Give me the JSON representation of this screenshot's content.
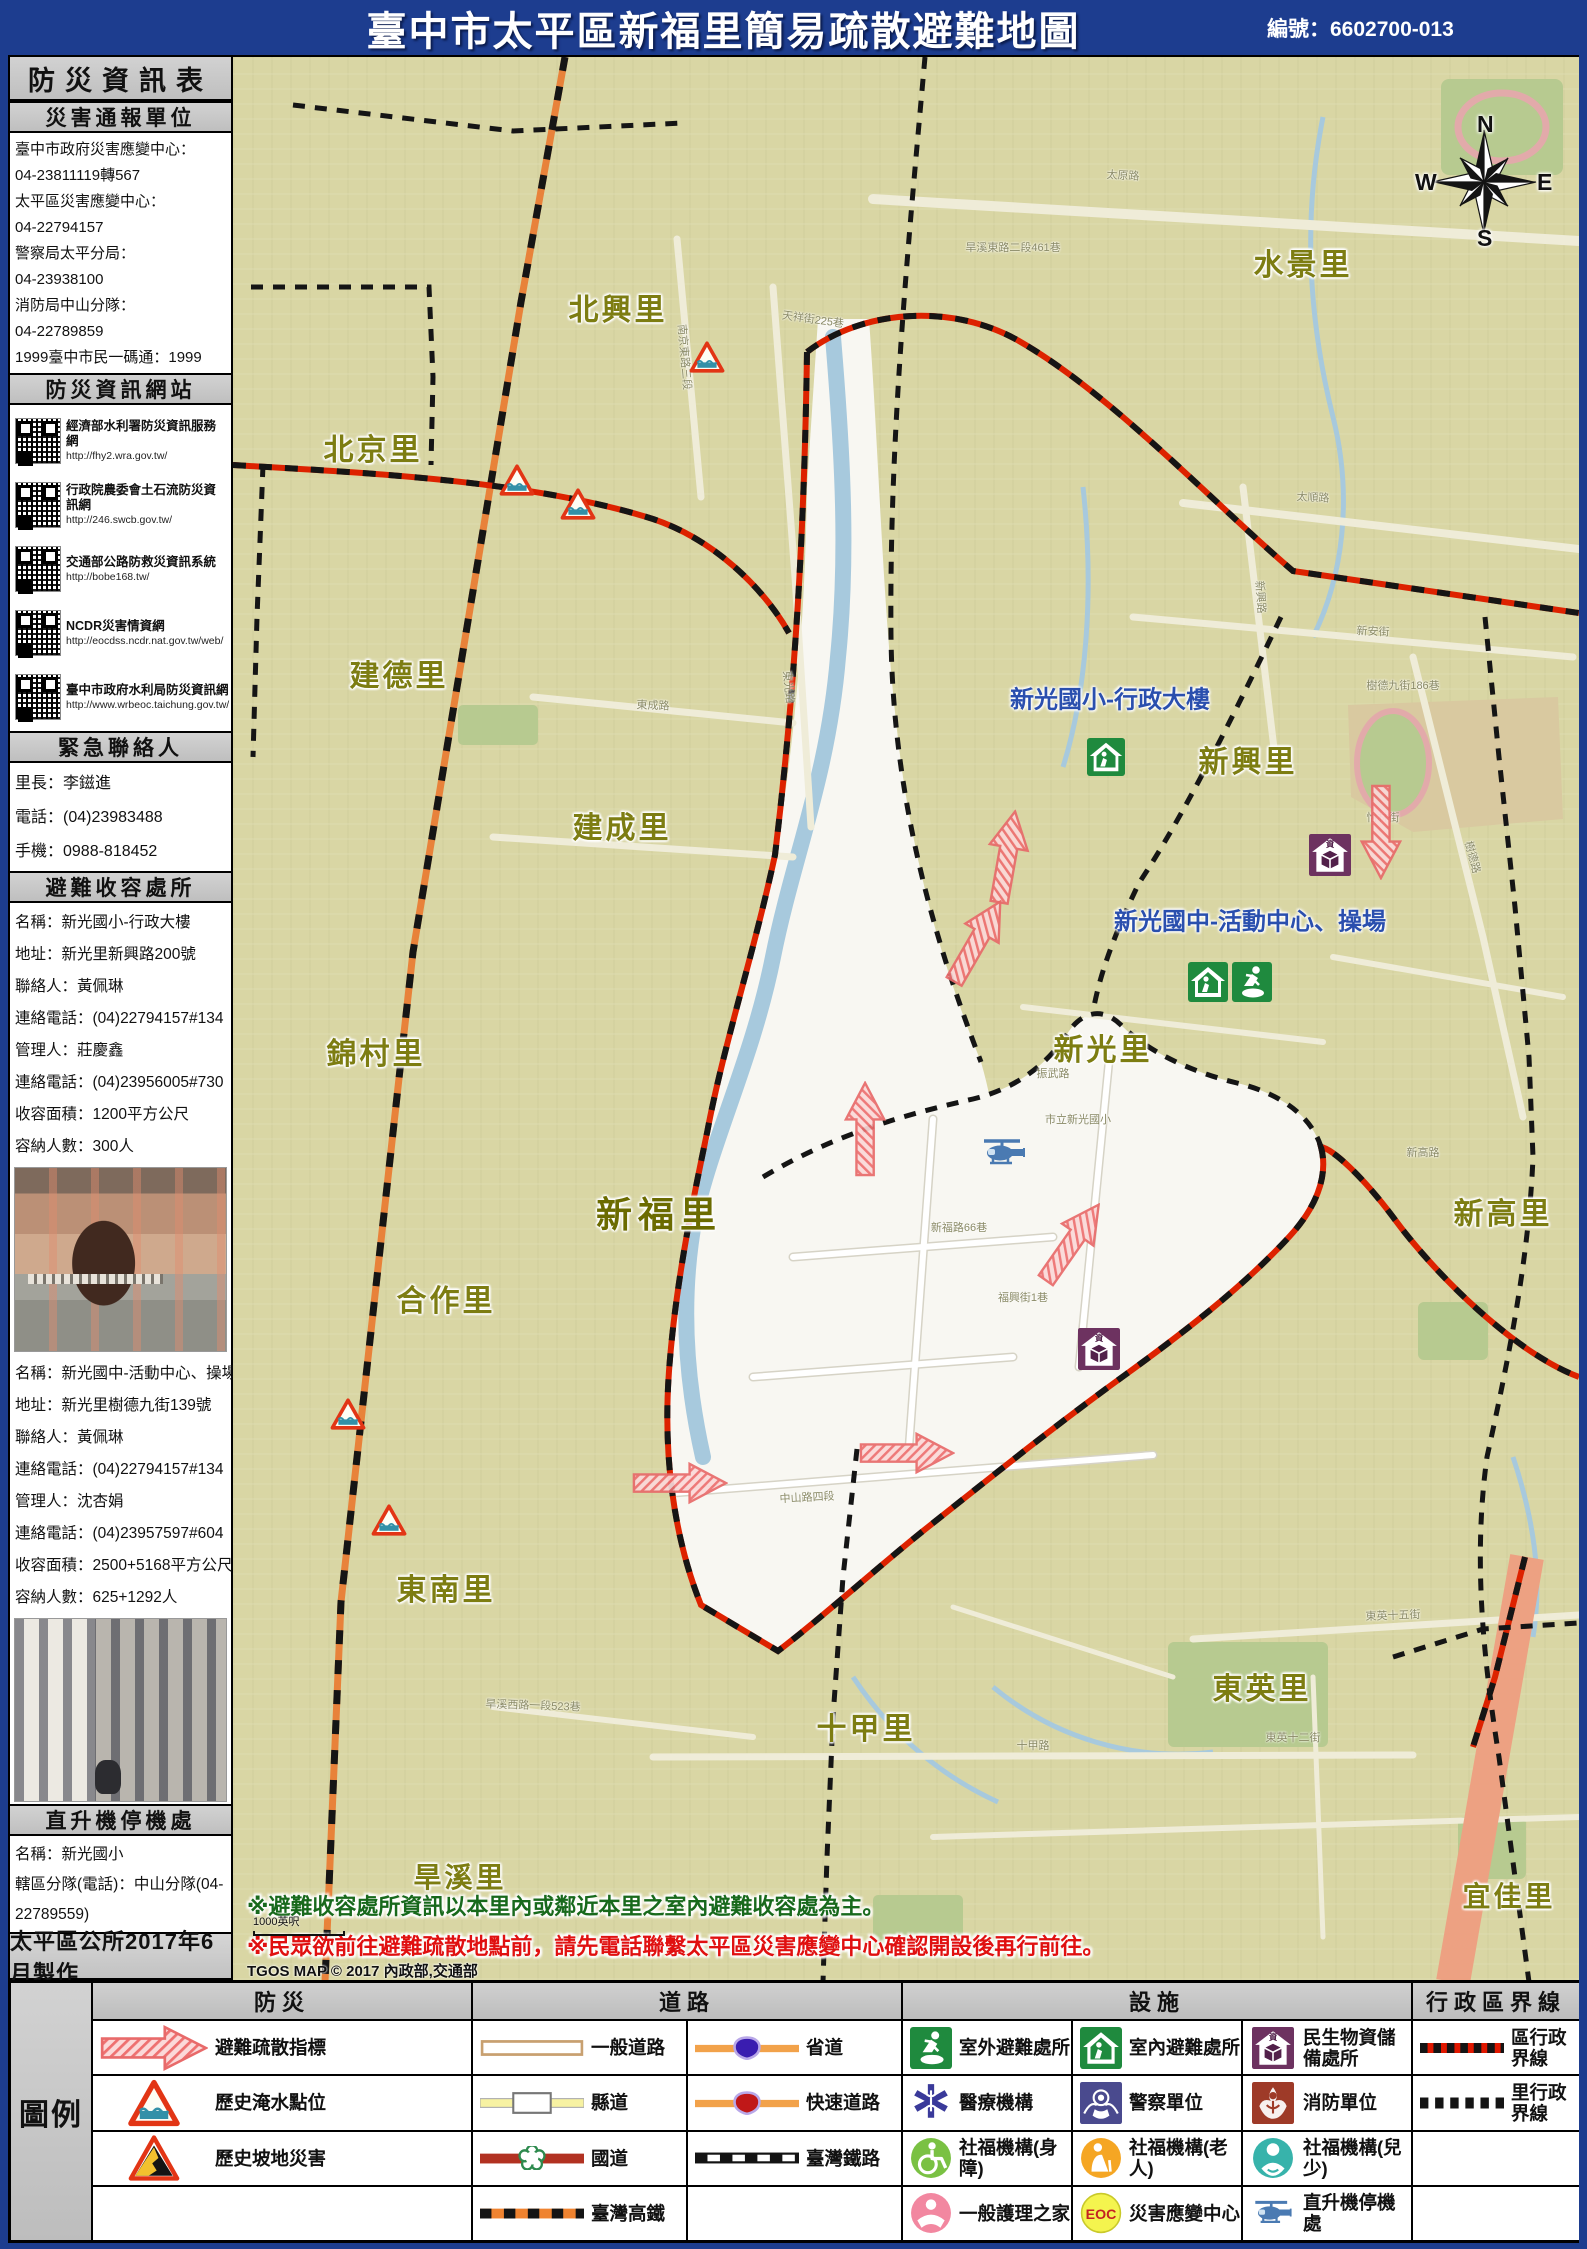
{
  "header": {
    "title": "臺中市太平區新福里簡易疏散避難地圖",
    "edition": "編號：6602700-013"
  },
  "sidebar": {
    "title": "防災資訊表",
    "report_units": {
      "title": "災害通報單位",
      "lines": [
        "臺中市政府災害應變中心：",
        "04-23811119轉567",
        "太平區災害應變中心：",
        "04-22794157",
        "警察局太平分局：",
        "04-23938100",
        "消防局中山分隊：",
        "04-22789859",
        "1999臺中市民一碼通：1999"
      ]
    },
    "websites": {
      "title": "防災資訊網站",
      "items": [
        {
          "name": "經濟部水利署防災資訊服務網",
          "url": "http://fhy2.wra.gov.tw/"
        },
        {
          "name": "行政院農委會土石流防災資訊網",
          "url": "http://246.swcb.gov.tw/"
        },
        {
          "name": "交通部公路防救災資訊系統",
          "url": "http://bobe168.tw/"
        },
        {
          "name": "NCDR災害情資網",
          "url": "http://eocdss.ncdr.nat.gov.tw/web/"
        },
        {
          "name": "臺中市政府水利局防災資訊網",
          "url": "http://www.wrbeoc.taichung.gov.tw/"
        }
      ]
    },
    "contacts": {
      "title": "緊急聯絡人",
      "lines": [
        "里長：李鎡進",
        "電話：(04)23983488",
        "手機：0988-818452"
      ]
    },
    "shelters": {
      "title": "避難收容處所",
      "shelter1_lines": [
        "名稱：新光國小-行政大樓",
        "地址：新光里新興路200號",
        "聯絡人：黃佩琳",
        "連絡電話：(04)22794157#134",
        "管理人：莊慶鑫",
        "連絡電話：(04)23956005#730",
        "收容面積：1200平方公尺",
        "容納人數：300人"
      ],
      "shelter2_lines": [
        "名稱：新光國中-活動中心、操場",
        "地址：新光里樹德九街139號",
        "聯絡人：黃佩琳",
        "連絡電話：(04)22794157#134",
        "管理人：沈杏娟",
        "連絡電話：(04)23957597#604",
        "收容面積：2500+5168平方公尺",
        "容納人數：625+1292人"
      ]
    },
    "heliport": {
      "title": "直升機停機處",
      "lines": [
        "名稱：新光國小",
        "轄區分隊(電話)：中山分隊(04-22789559)"
      ]
    },
    "footer": "太平區公所2017年6月製作"
  },
  "map": {
    "villages": [
      {
        "name": "北興里",
        "x": 385,
        "y": 250,
        "size": 30
      },
      {
        "name": "北京里",
        "x": 140,
        "y": 390,
        "size": 30
      },
      {
        "name": "水景里",
        "x": 1070,
        "y": 205,
        "size": 30
      },
      {
        "name": "建德里",
        "x": 166,
        "y": 616,
        "size": 30
      },
      {
        "name": "建成里",
        "x": 389,
        "y": 768,
        "size": 30
      },
      {
        "name": "錦村里",
        "x": 143,
        "y": 994,
        "size": 30
      },
      {
        "name": "新興里",
        "x": 1015,
        "y": 702,
        "size": 30
      },
      {
        "name": "新光里",
        "x": 870,
        "y": 990,
        "size": 30
      },
      {
        "name": "新高里",
        "x": 1270,
        "y": 1154,
        "size": 30
      },
      {
        "name": "新福里",
        "x": 426,
        "y": 1155,
        "size": 36,
        "dark": true
      },
      {
        "name": "合作里",
        "x": 213,
        "y": 1241,
        "size": 30
      },
      {
        "name": "東南里",
        "x": 213,
        "y": 1530,
        "size": 30
      },
      {
        "name": "十甲里",
        "x": 633,
        "y": 1669,
        "size": 30
      },
      {
        "name": "東英里",
        "x": 1029,
        "y": 1629,
        "size": 30
      },
      {
        "name": "旱溪里",
        "x": 227,
        "y": 1819,
        "size": 28
      },
      {
        "name": "宜佳里",
        "x": 1276,
        "y": 1838,
        "size": 28
      }
    ],
    "facilities": [
      {
        "label": "新光國小-行政大樓",
        "x": 877,
        "y": 640
      },
      {
        "label": "新光國中-活動中心、操場",
        "x": 1017,
        "y": 862
      }
    ],
    "markers": [
      {
        "icon": "shelter-indoor",
        "x": 873,
        "y": 700,
        "w": 38,
        "h": 38
      },
      {
        "icon": "shelter-indoor",
        "x": 975,
        "y": 925,
        "w": 40,
        "h": 40
      },
      {
        "icon": "shelter-outdoor",
        "x": 1019,
        "y": 925,
        "w": 40,
        "h": 40
      },
      {
        "icon": "supplies",
        "x": 1097,
        "y": 798,
        "w": 42,
        "h": 42
      },
      {
        "icon": "supplies",
        "x": 866,
        "y": 1292,
        "w": 42,
        "h": 42
      },
      {
        "icon": "heliport",
        "x": 771,
        "y": 1096,
        "w": 52,
        "h": 34
      },
      {
        "icon": "flood-marker",
        "x": 474,
        "y": 300,
        "w": 36,
        "h": 33
      },
      {
        "icon": "flood-marker",
        "x": 284,
        "y": 423,
        "w": 36,
        "h": 33
      },
      {
        "icon": "flood-marker",
        "x": 345,
        "y": 447,
        "w": 36,
        "h": 33
      },
      {
        "icon": "flood-marker",
        "x": 115,
        "y": 1357,
        "w": 36,
        "h": 33
      },
      {
        "icon": "flood-marker",
        "x": 156,
        "y": 1463,
        "w": 36,
        "h": 33
      }
    ],
    "arrows": [
      {
        "x": 775,
        "y": 800,
        "r": -80
      },
      {
        "x": 633,
        "y": 1072,
        "r": -90
      },
      {
        "x": 840,
        "y": 1186,
        "r": -55
      },
      {
        "x": 674,
        "y": 1397,
        "r": 0
      },
      {
        "x": 447,
        "y": 1427,
        "r": 0
      },
      {
        "x": 1147,
        "y": 775,
        "r": 90
      },
      {
        "x": 745,
        "y": 885,
        "r": -60
      }
    ],
    "streets": [
      {
        "name": "太原路",
        "x": 890,
        "y": 118,
        "r": 3
      },
      {
        "name": "旱溪東路二段461巷",
        "x": 780,
        "y": 190,
        "r": 0
      },
      {
        "name": "天祥街225巷",
        "x": 580,
        "y": 262,
        "r": 8
      },
      {
        "name": "南京東路三段",
        "x": 452,
        "y": 300,
        "r": 85
      },
      {
        "name": "東光路",
        "x": 556,
        "y": 630,
        "r": 84
      },
      {
        "name": "太順路",
        "x": 1080,
        "y": 440,
        "r": 3
      },
      {
        "name": "新安街",
        "x": 1140,
        "y": 574,
        "r": 2
      },
      {
        "name": "新興路",
        "x": 1028,
        "y": 540,
        "r": 86
      },
      {
        "name": "樹德九街186巷",
        "x": 1170,
        "y": 628,
        "r": 0
      },
      {
        "name": "東成路",
        "x": 420,
        "y": 648,
        "r": 2
      },
      {
        "name": "怡林街",
        "x": 1150,
        "y": 760,
        "r": 0
      },
      {
        "name": "樹德路",
        "x": 1240,
        "y": 800,
        "r": 75
      },
      {
        "name": "振武路",
        "x": 820,
        "y": 1016,
        "r": 0
      },
      {
        "name": "新高路",
        "x": 1190,
        "y": 1095,
        "r": 0
      },
      {
        "name": "市立新光國小",
        "x": 845,
        "y": 1062,
        "r": 0
      },
      {
        "name": "中山路四段",
        "x": 574,
        "y": 1440,
        "r": -3
      },
      {
        "name": "新福路66巷",
        "x": 726,
        "y": 1170,
        "r": 0
      },
      {
        "name": "福興街1巷",
        "x": 790,
        "y": 1240,
        "r": 0
      },
      {
        "name": "十甲路",
        "x": 800,
        "y": 1688,
        "r": 0
      },
      {
        "name": "東英十五街",
        "x": 1160,
        "y": 1558,
        "r": -2
      },
      {
        "name": "東英十二街",
        "x": 1060,
        "y": 1680,
        "r": 0
      },
      {
        "name": "旱溪西路一段523巷",
        "x": 300,
        "y": 1648,
        "r": 2
      }
    ],
    "compass": {
      "n": "N",
      "e": "E",
      "s": "S",
      "w": "W"
    },
    "notes": {
      "note1": "※避難收容處所資訊以本里內或鄰近本里之室內避難收容處為主。",
      "note2": "※民眾欲前往避難疏散地點前，請先電話聯繫太平區災害應變中心確認開設後再行前往。",
      "attribution": "TGOS MAP © 2017 內政部,交通部",
      "scale_label": "1000英呎"
    }
  },
  "legend": {
    "title": "圖例",
    "columns": [
      {
        "header": "防災",
        "subcols": [
          {
            "iconw": 108,
            "iconh": 48,
            "rows": [
              {
                "icon": "evac-arrow",
                "label": "避難疏散指標"
              },
              {
                "icon": "flood-marker",
                "label": "歷史淹水點位"
              },
              {
                "icon": "slope-marker",
                "label": "歷史坡地災害"
              },
              {
                "icon": "",
                "label": ""
              }
            ]
          }
        ]
      },
      {
        "header": "道路",
        "subcols": [
          {
            "iconw": 104,
            "iconh": 24,
            "rows": [
              {
                "icon": "road-general",
                "label": "一般道路"
              },
              {
                "icon": "road-county",
                "label": "縣道"
              },
              {
                "icon": "road-national",
                "label": "國道"
              },
              {
                "icon": "road-hsr",
                "label": "臺灣高鐵"
              }
            ]
          },
          {
            "iconw": 104,
            "iconh": 24,
            "rows": [
              {
                "icon": "road-provincial",
                "label": "省道"
              },
              {
                "icon": "road-express",
                "label": "快速道路"
              },
              {
                "icon": "road-rail",
                "label": "臺灣鐵路"
              },
              {
                "icon": "",
                "label": ""
              }
            ]
          }
        ]
      },
      {
        "header": "設施",
        "subcols": [
          {
            "iconw": 42,
            "iconh": 42,
            "rows": [
              {
                "icon": "shelter-outdoor",
                "label": "室外避難處所"
              },
              {
                "icon": "medical",
                "label": "醫療機構"
              },
              {
                "icon": "welfare-disabled",
                "label": "社福機構(身障)"
              },
              {
                "icon": "nursing",
                "label": "一般護理之家"
              }
            ]
          },
          {
            "iconw": 42,
            "iconh": 42,
            "rows": [
              {
                "icon": "shelter-indoor",
                "label": "室內避難處所"
              },
              {
                "icon": "police",
                "label": "警察單位"
              },
              {
                "icon": "welfare-elderly",
                "label": "社福機構(老人)"
              },
              {
                "icon": "eoc",
                "label": "災害應變中心"
              }
            ]
          },
          {
            "iconw": 46,
            "iconh": 42,
            "rows": [
              {
                "icon": "supplies",
                "label": "民生物資儲備處所"
              },
              {
                "icon": "fire",
                "label": "消防單位"
              },
              {
                "icon": "welfare-child",
                "label": "社福機構(兒少)"
              },
              {
                "icon": "heliport",
                "label": "直升機停機處"
              }
            ]
          }
        ]
      },
      {
        "header": "行政區界線",
        "subcols": [
          {
            "iconw": 84,
            "iconh": 20,
            "rows": [
              {
                "icon": "boundary-district",
                "label": "區行政界線"
              },
              {
                "icon": "boundary-village",
                "label": "里行政界線"
              },
              {
                "icon": "",
                "label": ""
              },
              {
                "icon": "",
                "label": ""
              }
            ]
          }
        ]
      }
    ]
  }
}
